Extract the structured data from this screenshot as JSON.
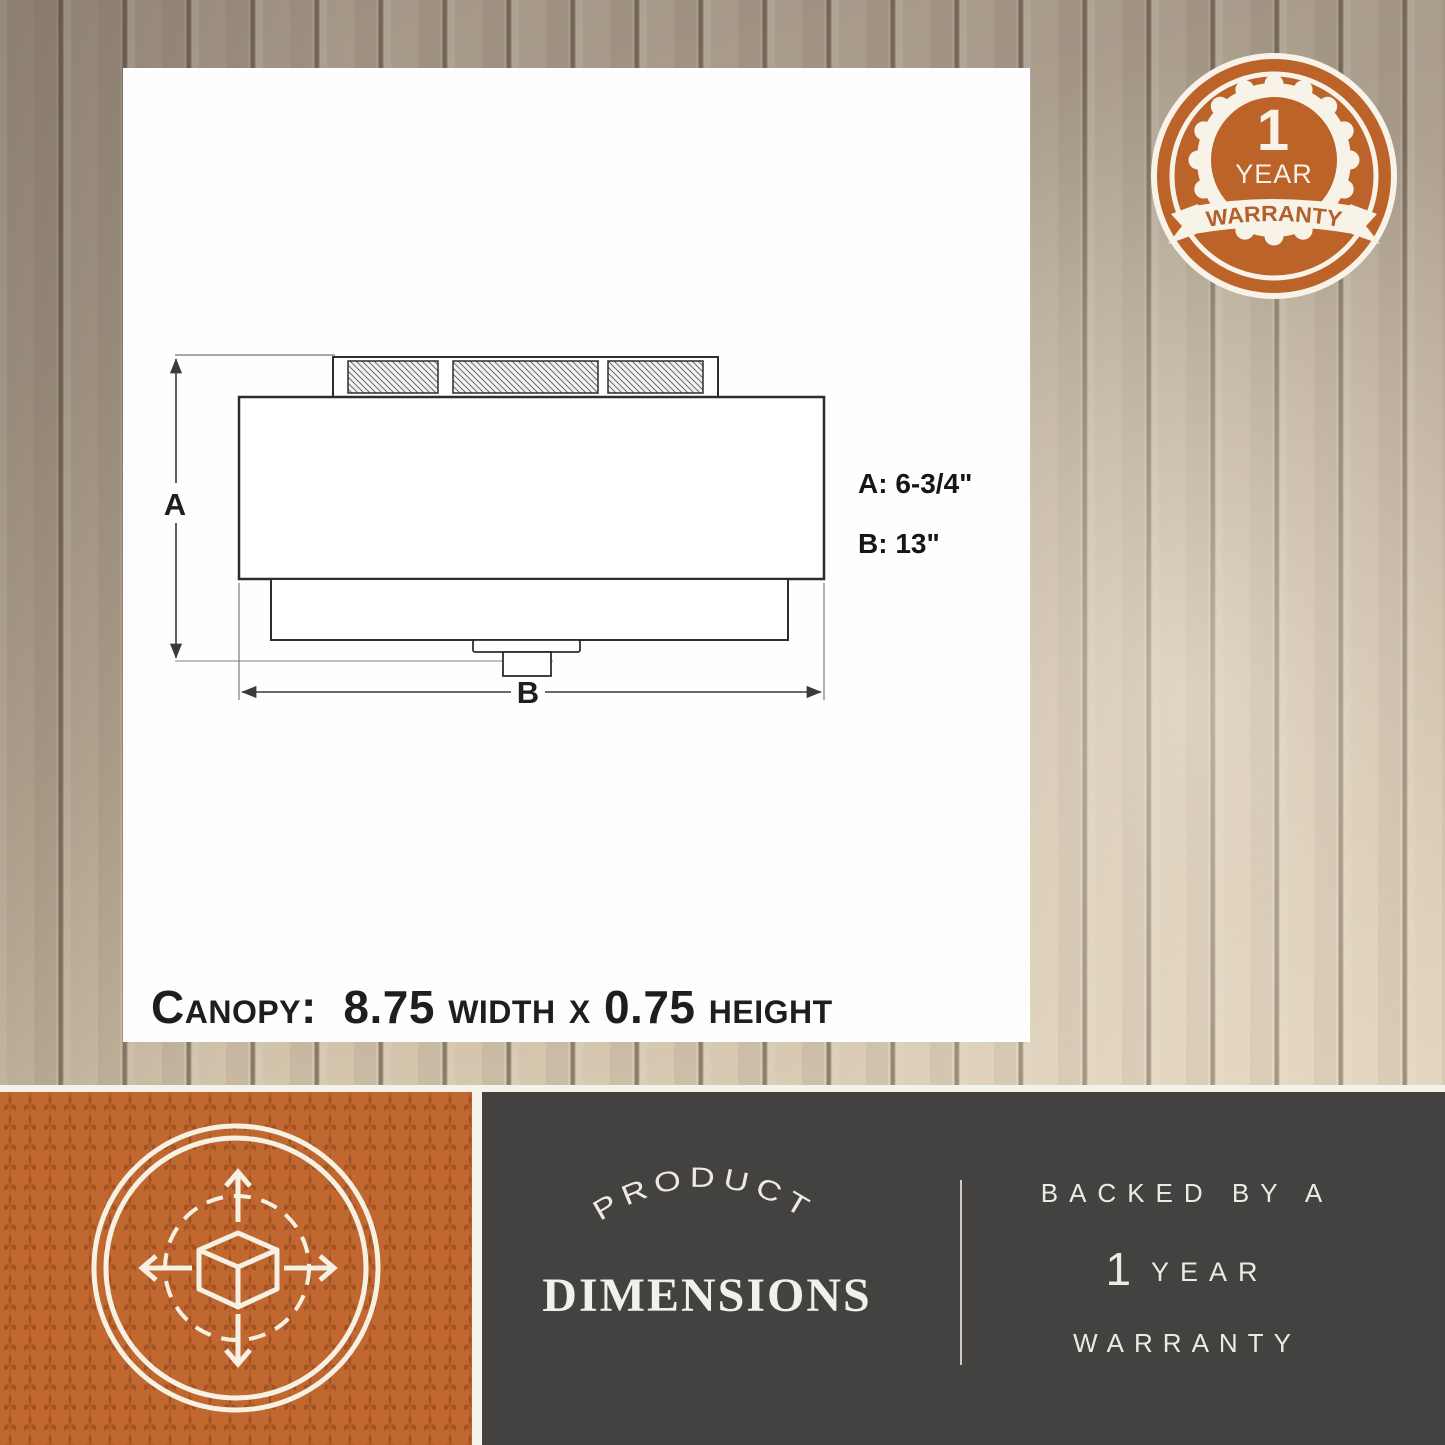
{
  "diagram": {
    "dim_a_letter": "A",
    "dim_b_letter": "B",
    "dim_a_value": "A: 6-3/4\"",
    "dim_b_value": "B: 13\"",
    "canopy_note": "Canopy:  8.75 width x 0.75 height"
  },
  "badge": {
    "number": "1",
    "year": "YEAR",
    "banner": "WARRANTY"
  },
  "bottom_center": {
    "arc_text": "PRODUCT",
    "title": "DIMENSIONS"
  },
  "bottom_right": {
    "line1": "BACKED BY A",
    "number": "1",
    "year": "YEAR",
    "line3": "WARRANTY"
  },
  "colors": {
    "accent_orange": "#bc6329",
    "pattern_orange_dark": "#9d4e20",
    "dark_gray": "#434240",
    "cream": "#f8f3e8",
    "ink": "#1e1e1e"
  }
}
